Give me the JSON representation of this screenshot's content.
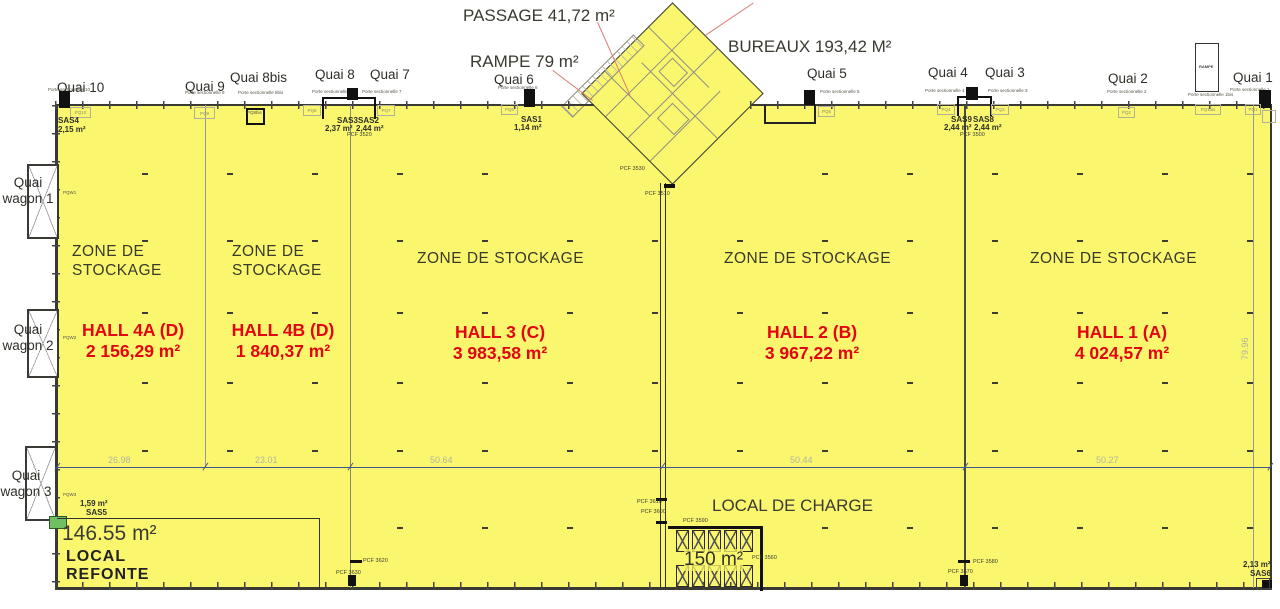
{
  "annotations": {
    "passage": "PASSAGE 41,72 m²",
    "rampe": "RAMPE 79 m²",
    "bureaux": "BUREAUX 193,42 M²",
    "rampe_small": "RAMPE"
  },
  "quais": {
    "q1": {
      "label": "Quai 1",
      "pq": "PQ1",
      "porte": "Porte sectionnelle 1"
    },
    "q1b": {
      "pq": "PQ1bis",
      "porte": "Porte sectionnelle 1bis"
    },
    "q2": {
      "label": "Quai 2",
      "pq": "PQ2",
      "porte": "Porte sectionnelle 2"
    },
    "q3": {
      "label": "Quai 3",
      "pq": "PQ3",
      "porte": "Porte sectionnelle 3"
    },
    "q4": {
      "label": "Quai 4",
      "pq": "PQ4",
      "porte": "Porte sectionnelle 4"
    },
    "q5": {
      "label": "Quai 5",
      "pq": "PQ5",
      "porte": "Porte sectionnelle 5"
    },
    "q6": {
      "label": "Quai 6",
      "pq": "PQ6",
      "porte": "Porte sectionnelle 6"
    },
    "q7": {
      "label": "Quai 7",
      "pq": "PQ7",
      "porte": "Porte sectionnelle 7"
    },
    "q8": {
      "label": "Quai 8",
      "pq": "PQ8",
      "porte": "Porte sectionnelle 8"
    },
    "q8b": {
      "label": "Quai 8bis",
      "pq": "PQ8bis",
      "porte": "Porte sectionnelle 8bis"
    },
    "q9": {
      "label": "Quai 9",
      "pq": "PQ9",
      "porte": "Porte sectionnelle 9"
    },
    "q10": {
      "label": "Quai 10",
      "pq": "PQ10",
      "porte": "Porte sectionnelle 10"
    }
  },
  "wagons": {
    "w1": {
      "l1": "Quai",
      "l2": "wagon 1",
      "tag": "PQW1"
    },
    "w2": {
      "l1": "Quai",
      "l2": "wagon 2",
      "tag": "PQW2"
    },
    "w3": {
      "l1": "Quai",
      "l2": "wagon 3",
      "tag": "PQW3"
    }
  },
  "halls": {
    "h4a": {
      "zone_l1": "ZONE DE",
      "zone_l2": "STOCKAGE",
      "name": "HALL 4A (D)",
      "area": "2 156,29 m²"
    },
    "h4b": {
      "zone_l1": "ZONE DE",
      "zone_l2": "STOCKAGE",
      "name": "HALL 4B (D)",
      "area": "1 840,37 m²"
    },
    "h3": {
      "zone": "ZONE DE STOCKAGE",
      "name": "HALL 3 (C)",
      "area": "3 983,58 m²"
    },
    "h2": {
      "zone": "ZONE DE STOCKAGE",
      "name": "HALL 2 (B)",
      "area": "3 967,22 m²"
    },
    "h1": {
      "zone": "ZONE DE STOCKAGE",
      "name": "HALL 1 (A)",
      "area": "4 024,57 m²"
    }
  },
  "sas": {
    "sas1": {
      "name": "SAS1",
      "area": "1,14 m²"
    },
    "sas2": {
      "name": "SAS2",
      "area": "2,44 m²"
    },
    "sas3": {
      "name": "SAS3",
      "area": "2,37 m²"
    },
    "sas4": {
      "name": "SAS4",
      "area": "2,15 m²"
    },
    "sas5": {
      "name": "SAS5",
      "area": "1,59 m²"
    },
    "sas6": {
      "name": "SAS6",
      "area": "2,13 m²"
    },
    "sas8": {
      "name": "SAS8",
      "area": "2,44 m²"
    },
    "sas9": {
      "name": "SAS9",
      "area": "2,44 m²"
    }
  },
  "pcf": {
    "p3500": "PCF 3500",
    "p3510": "PCF 3510",
    "p3520": "PCF 3520",
    "p3530": "PCF 3530",
    "p3560": "PCF 3560",
    "p3570": "PCF 3570",
    "p3580": "PCF 3580",
    "p3590": "PCF 3590",
    "p3600": "PCF 3600",
    "p3610": "PCF 3610",
    "p3620": "PCF 3620",
    "p3630": "PCF 3630"
  },
  "dimensions": {
    "d4a": "26.98",
    "d4b": "23.01",
    "d3": "50.64",
    "d2": "50.44",
    "d1": "50.27",
    "height": "79.96"
  },
  "locals": {
    "refonte": {
      "area": "146.55 m²",
      "l1": "LOCAL",
      "l2": "REFONTE"
    },
    "charge": {
      "title": "LOCAL DE CHARGE",
      "area": "150 m²"
    }
  },
  "colors": {
    "floor_yellow": "#faf76e",
    "hall_red": "#e20613",
    "wall_dark": "#3a3a35",
    "dim_blue": "#46568c",
    "dim_gray": "#b3b3a0",
    "leader_red": "#d97a72",
    "sas5_green": "#6fbf63"
  }
}
